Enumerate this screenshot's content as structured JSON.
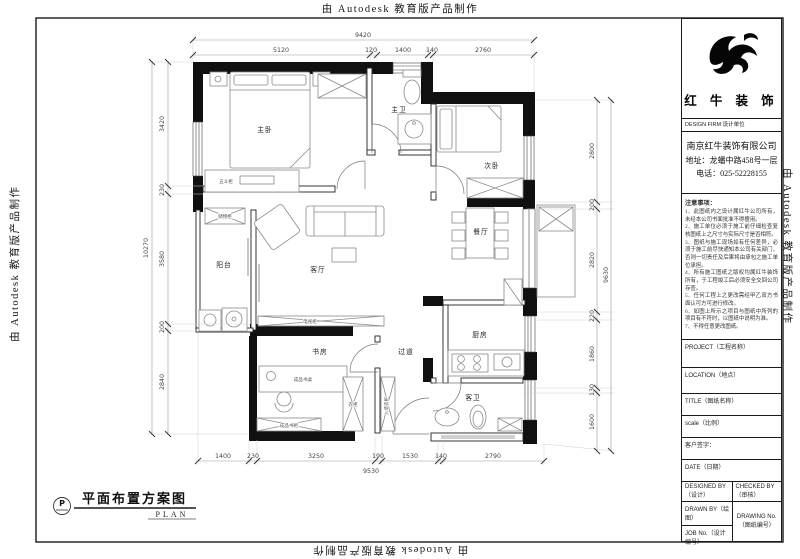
{
  "watermark": {
    "text": "由 Autodesk 教育版产品制作"
  },
  "plan": {
    "rooms": {
      "master_bedroom": "主卧",
      "master_bath": "主卫",
      "bedroom2": "次卧",
      "living": "客厅",
      "dining": "餐厅",
      "kitchen": "厨房",
      "guest_bath": "客卫",
      "study": "书房",
      "balcony": "阳台",
      "hallway": "过道"
    },
    "furniture": {
      "dresser": "五斗柜",
      "storage_cabinet": "储物柜",
      "tv_cabinet": "电视柜",
      "desk": "成品书桌",
      "bookcase": "成品书柜",
      "wardrobe": "衣柜",
      "built_in_wardrobe": "入墙衣柜"
    },
    "dims": {
      "top_total": "9420",
      "top": [
        "5120",
        "120",
        "1400",
        "140",
        "2760"
      ],
      "bottom": [
        "1400",
        "230",
        "3250",
        "190",
        "1530",
        "140",
        "2790"
      ],
      "bottom_total": "9530",
      "left": [
        "3420",
        "230",
        "3580",
        "200",
        "2840"
      ],
      "left_total": "10270",
      "right": [
        "2800",
        "200",
        "2820",
        "220",
        "1860",
        "130",
        "1600"
      ],
      "right_total": "9630"
    }
  },
  "title_block": {
    "brand": "红 牛 装 饰",
    "design_firm": "DESIGN FIRM  设计单位",
    "company": {
      "name": "南京红牛装饰有限公司",
      "address": "地址：龙蟠中路458号一层",
      "phone": "电话：025-52228155"
    },
    "notes_title": "注意事项：",
    "notes": [
      "1、此图纸内之设计属红牛公司所有，未经本公司书面批准不得擅用。",
      "2、施工单位必须于施工前仔细检查复核图纸上之尺寸与实际尺寸是否相符。",
      "3、图纸与施工现场如有任何差异，必须于施工前尽快通知本公司有关部门，否则一切责任及后果将由承包之施工单位承担。",
      "4、所有施工图纸之版权均属红牛装饰所有，于工程竣工后必须安全交回公司存查。",
      "5、任何工程上之更改需经甲乙双方书面认可方可进行修改。",
      "6、如图上所示之项目与图纸中所列的项目有不符时，以图纸中说明为准。",
      "7、不得任意更改图纸。"
    ],
    "fields": {
      "project_label": "PROJECT（工程名称）",
      "location_label": "LOCATION（地点）",
      "title_label": "TITLE（图纸名称）",
      "scale_label": "scale（比例）",
      "client_sign_label": "客户签字：",
      "date_label": "DATE（日期）",
      "designed_label": "DESIGNED BY（设计）",
      "checked_label": "CHECKED BY（审核）",
      "drawn_label": "DRAWN BY（绘图）",
      "drawing_no_label": "DRAWING No.（图纸编号）",
      "job_no_label": "JOB No.（设计编号）"
    }
  },
  "footer": {
    "symbol": "P",
    "title": "平面布置方案图",
    "subtitle": "PLAN"
  }
}
